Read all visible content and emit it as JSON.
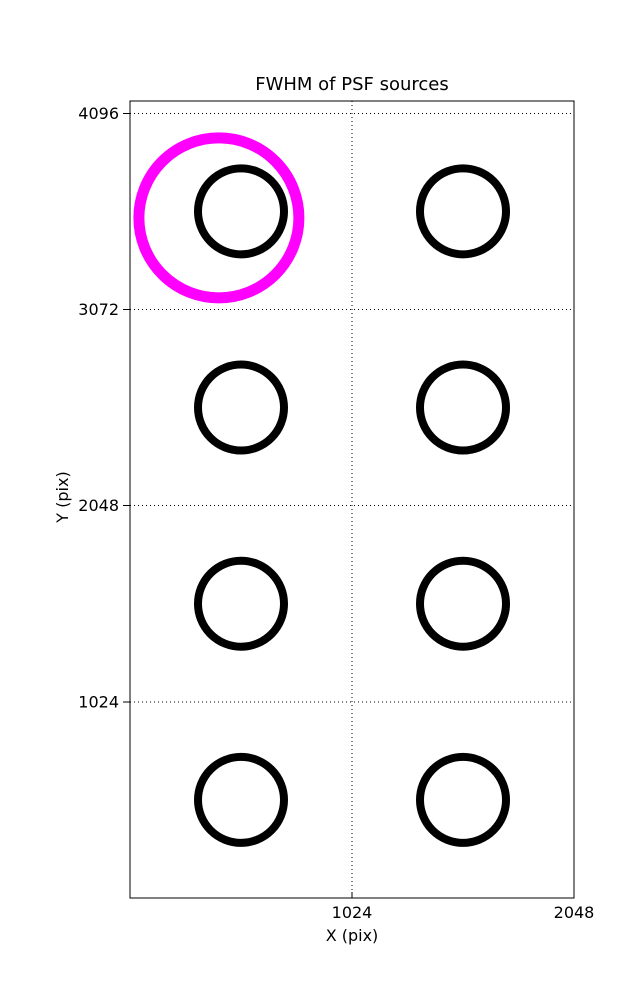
{
  "figure": {
    "background": "#ffffff",
    "width": 637,
    "height": 1000
  },
  "chart_data": {
    "type": "scatter",
    "title": "FWHM of PSF sources",
    "xlabel": "X (pix)",
    "ylabel": "Y (pix)",
    "xlim": [
      0,
      2048
    ],
    "ylim": [
      0,
      4160
    ],
    "xticks": [
      1024,
      2048
    ],
    "yticks": [
      1024,
      2048,
      3072,
      4096
    ],
    "grid": {
      "style": "dotted",
      "color": "#000000",
      "vertical_at": [
        1024
      ],
      "horizontal_at": [
        1024,
        2048,
        3072,
        4096
      ]
    },
    "axis_color": "#000000",
    "legend": "none",
    "series": [
      {
        "name": "psf-source-circles",
        "color": "#000000",
        "marker": "open-circle",
        "marker_radius_px": 43,
        "line_width_px": 8,
        "points": [
          [
            512,
            3584
          ],
          [
            1536,
            3584
          ],
          [
            512,
            2560
          ],
          [
            1536,
            2560
          ],
          [
            512,
            1536
          ],
          [
            1536,
            1536
          ],
          [
            512,
            512
          ],
          [
            1536,
            512
          ]
        ]
      },
      {
        "name": "highlighted-source-circle",
        "color": "#ff00ff",
        "marker": "open-circle",
        "marker_radius_px": 80,
        "line_width_px": 11,
        "points": [
          [
            410,
            3550
          ]
        ]
      }
    ]
  }
}
